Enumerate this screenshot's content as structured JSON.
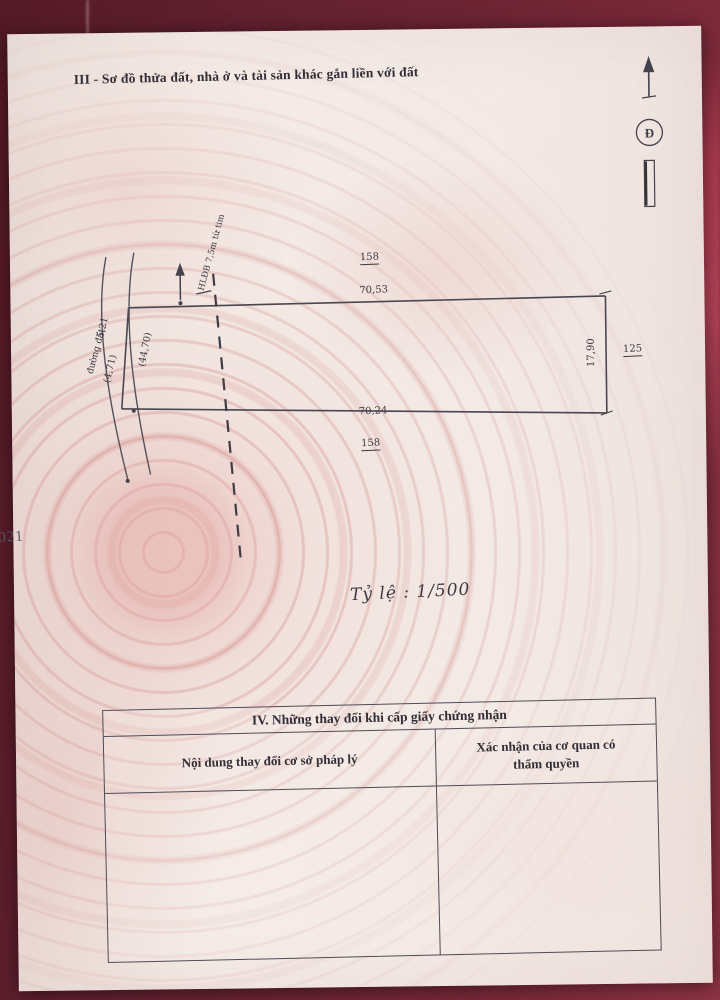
{
  "document": {
    "section_title": "III - Sơ đồ thửa đất, nhà ở và tài sản khác gắn liền với đất",
    "edge_number": "021",
    "scale_text": "Tỷ lệ : 1/500",
    "north_symbol_letter": "Đ"
  },
  "plot_diagram": {
    "road_name": "đường đất",
    "setback_note": "HLĐB 7,5m từ tim",
    "top_neighbor_plot": "158",
    "top_edge_length": "70,53",
    "bottom_edge_length": "70,24",
    "bottom_neighbor_plot": "158",
    "right_edge_length": "17,90",
    "right_neighbor_plot": "125",
    "left_segment_1": "5,21",
    "left_segment_2": "(4,71)",
    "left_inner_length": "(44,70)"
  },
  "changes_table": {
    "title": "IV. Những thay đổi khi cấp giấy chứng nhận",
    "col_content_header": "Nội dung thay đổi cơ sở pháp lý",
    "col_confirm_header_line1": "Xác nhận của cơ quan có",
    "col_confirm_header_line2": "thẩm  quyền"
  },
  "colors": {
    "cloth": "#6d2433",
    "cloth_bright": "#a83a4e",
    "paper": "#f2e9e5",
    "watermark": "#dd9b98",
    "ink": "#312e36",
    "line": "#4f4c55"
  }
}
